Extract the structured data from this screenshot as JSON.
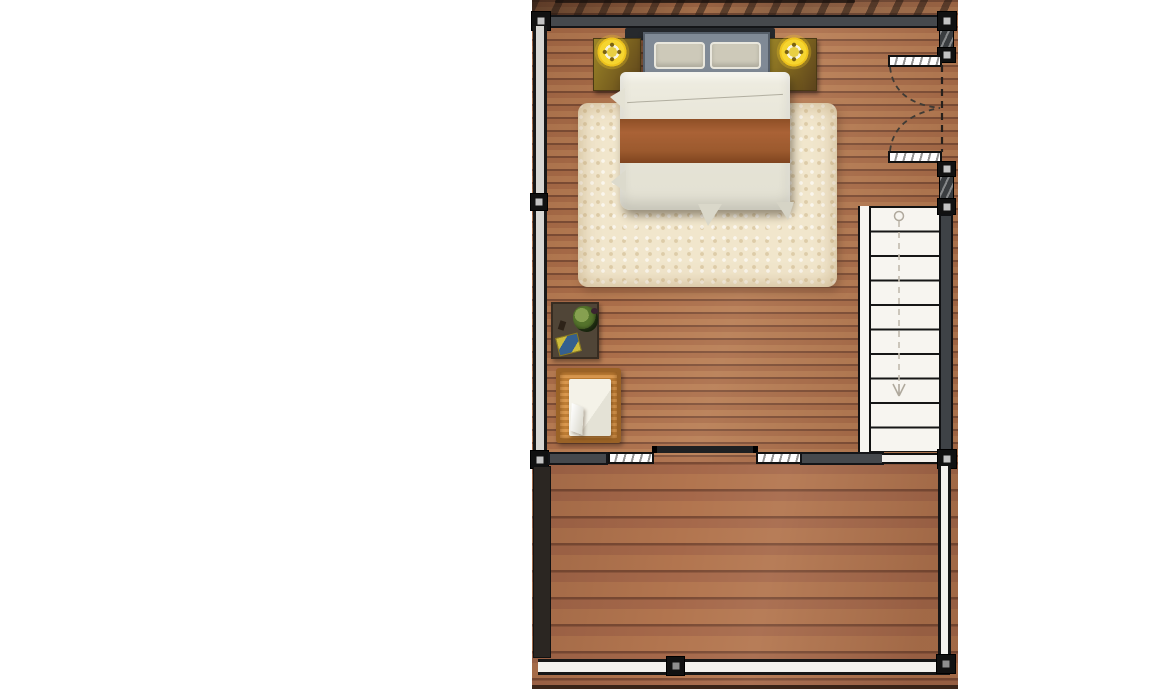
{
  "meta": {
    "type": "architectural floor plan",
    "view": "top-down",
    "description": "Upper-floor bedroom plan with wood flooring, double bed, nightstands with lamps, shag rug, desk, wicker chair, double entry door, descending staircase, and an open wood deck with perimeter railing"
  },
  "palette": {
    "page_background": "#ffffff",
    "bedroom_wood": "#aa6d49",
    "deck_wood": "#a5684a",
    "wall_dark_gray": "#46494d",
    "wall_line_black": "#141518",
    "stair_white": "#f7f5f0",
    "rug_cream": "#f1e6cc",
    "bed_linen": "#e9e7db",
    "bed_stripe_rust": "#9c5a2e",
    "headboard_gray": "#808a96",
    "lamp_yellow": "#f6d52f",
    "nightstand_gold": "#8a701f",
    "desk_brown": "#504537",
    "chair_wicker": "#d18a42",
    "railing_white": "#f3f1ed"
  },
  "rooms": {
    "bedroom": {
      "label": "Bedroom"
    },
    "deck": {
      "label": "Wood deck"
    }
  },
  "furniture": {
    "bed": {
      "label": "Double bed with gray headboard, two pillows and rust-striped duvet"
    },
    "nightstand_left": {
      "label": "Left nightstand with round glowing lamp"
    },
    "nightstand_right": {
      "label": "Right nightstand with round glowing lamp"
    },
    "rug": {
      "label": "Cream shag area rug"
    },
    "desk": {
      "label": "Dark wood desk with plant, book and phone"
    },
    "chair": {
      "label": "Wicker chair with white cushion"
    }
  },
  "architecture": {
    "stairs": {
      "label": "Staircase",
      "treads": 10,
      "direction": "down"
    },
    "double_door": {
      "label": "Double swing entry door",
      "swing": "two dashed quarter-circle leaves"
    },
    "sliding_door": {
      "label": "Sliding door between bedroom and deck"
    },
    "windows": {
      "label": "Window segments in deck wall",
      "count": 2
    },
    "railing": {
      "label": "Deck perimeter railing with posts"
    },
    "shadow": {
      "label": "Tree canopy shadow along top edge"
    }
  }
}
